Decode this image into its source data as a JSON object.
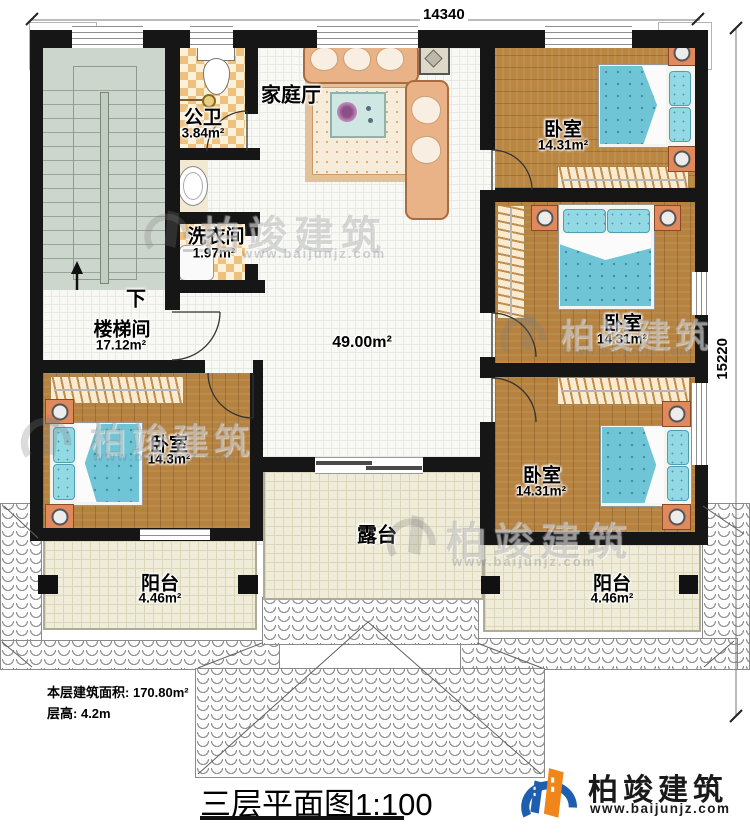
{
  "plan": {
    "title": "三层平面图",
    "scale": "1:100",
    "notes": {
      "area_label": "本层建筑面积:",
      "area_value": "170.80m²",
      "height_label": "层高:",
      "height_value": "4.2m"
    },
    "dimensions": {
      "width": "14340",
      "height": "15220"
    }
  },
  "rooms": {
    "family_hall": {
      "name": "家庭厅"
    },
    "public_bath": {
      "name": "公卫",
      "area": "3.84m²"
    },
    "laundry": {
      "name": "洗衣间",
      "area": "1.97m²"
    },
    "stairwell": {
      "name": "楼梯间",
      "area": "17.12m²",
      "down_label": "下"
    },
    "hall": {
      "area": "49.00m²"
    },
    "bedroom_top_right": {
      "name": "卧室",
      "area": "14.31m²"
    },
    "bedroom_mid_right": {
      "name": "卧室",
      "area": "14.31m²"
    },
    "bedroom_bottom_right": {
      "name": "卧室",
      "area": "14.31m²"
    },
    "bedroom_left": {
      "name": "卧室",
      "area": "14.3m²"
    },
    "terrace": {
      "name": "露台"
    },
    "balcony_left": {
      "name": "阳台",
      "area": "4.46m²"
    },
    "balcony_right": {
      "name": "阳台",
      "area": "4.46m²"
    }
  },
  "watermark": {
    "brand": "柏竣建筑",
    "url": "www.baijunjz.com"
  },
  "logo": {
    "brand": "柏竣建筑",
    "url": "www.baijunjz.com"
  },
  "colors": {
    "wall": "#161616",
    "wood": "#b5823f",
    "bed_teal": "#6fc5d5",
    "checker_tan": "#eec27e",
    "floor_cream": "#efecd9",
    "stair_green": "#cdd6cc",
    "logo_blue": "#1d5fae",
    "logo_orange": "#f08519"
  }
}
